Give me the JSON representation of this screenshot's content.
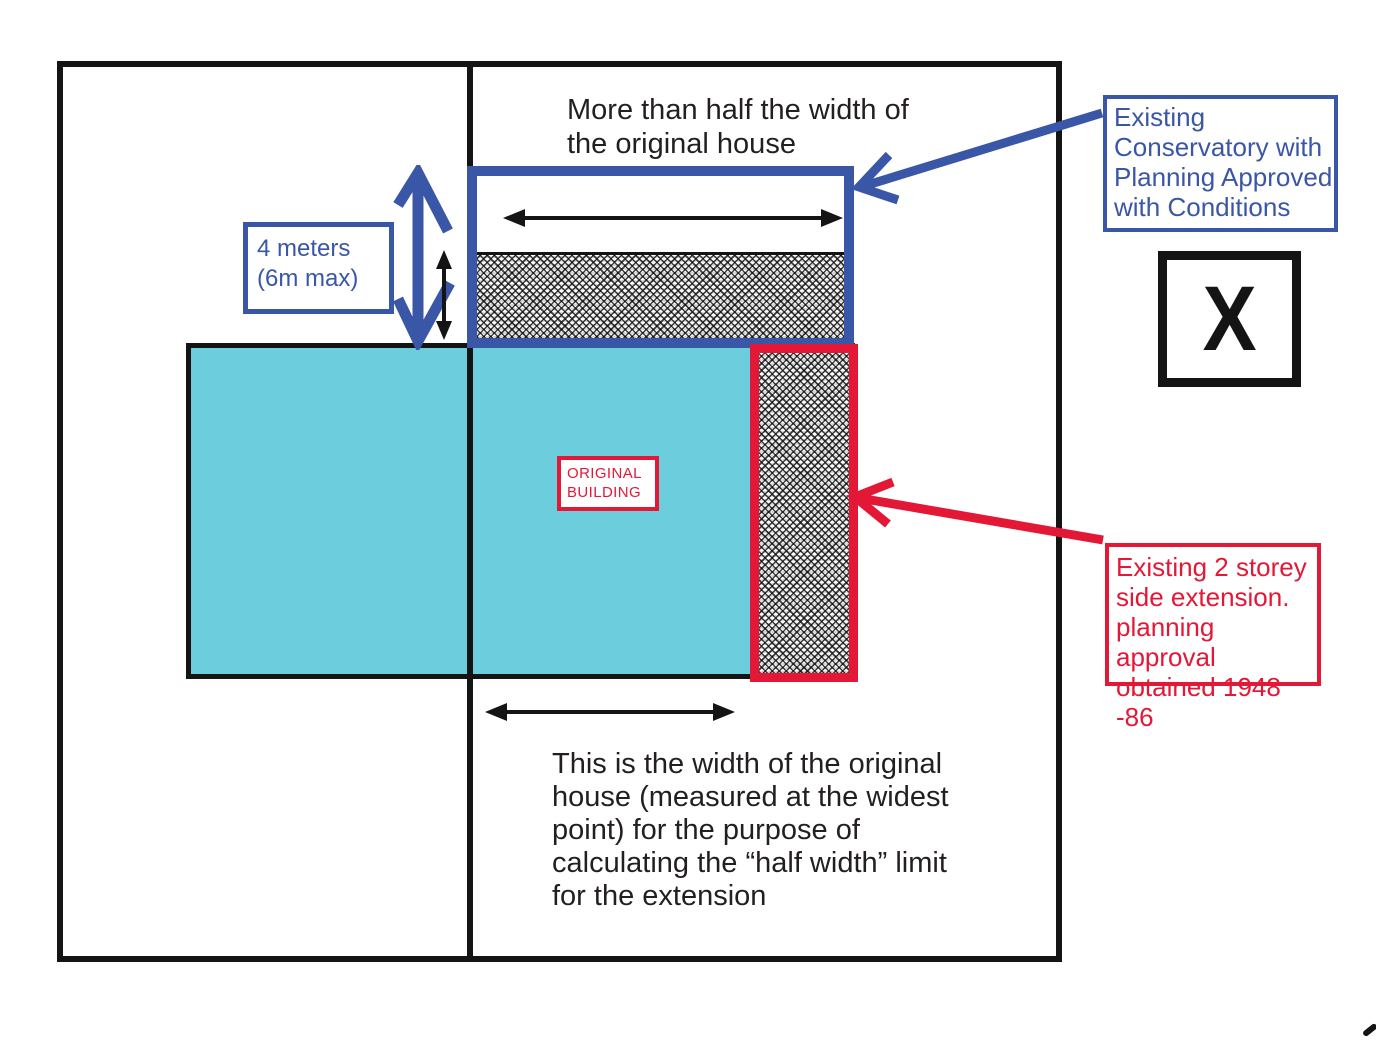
{
  "colors": {
    "blue": "#3A56A7",
    "red": "#E31837",
    "cyan": "#6CCDDC",
    "ink": "#141414",
    "text": "#231F20"
  },
  "labels": {
    "top_caption": "More than half the width of\nthe original house",
    "four_meters": "4 meters\n(6m max)",
    "original_building": "ORIGINAL\nBUILDING",
    "bottom_caption": "This is the width of the original\nhouse (measured at the widest\npoint) for the purpose of\ncalculating the “half width” limit\nfor the extension",
    "conservatory_note": "Existing\nConservatory with\nPlanning Approved\nwith Conditions",
    "extension_note": "Existing 2 storey\nside extension.\nplanning approval\nobtained 1948 -86",
    "x_marker": "X"
  },
  "icons": {
    "conservatory_width_arrow": "horizontal double-headed arrow",
    "house_width_arrow": "horizontal double-headed arrow",
    "depth_arrow_blue": "large hand-drawn vertical double arrow",
    "depth_arrow_black": "small vertical double arrow",
    "conservatory_pointer": "blue callout arrow pointing to conservatory",
    "extension_pointer": "red callout arrow pointing to side extension"
  }
}
